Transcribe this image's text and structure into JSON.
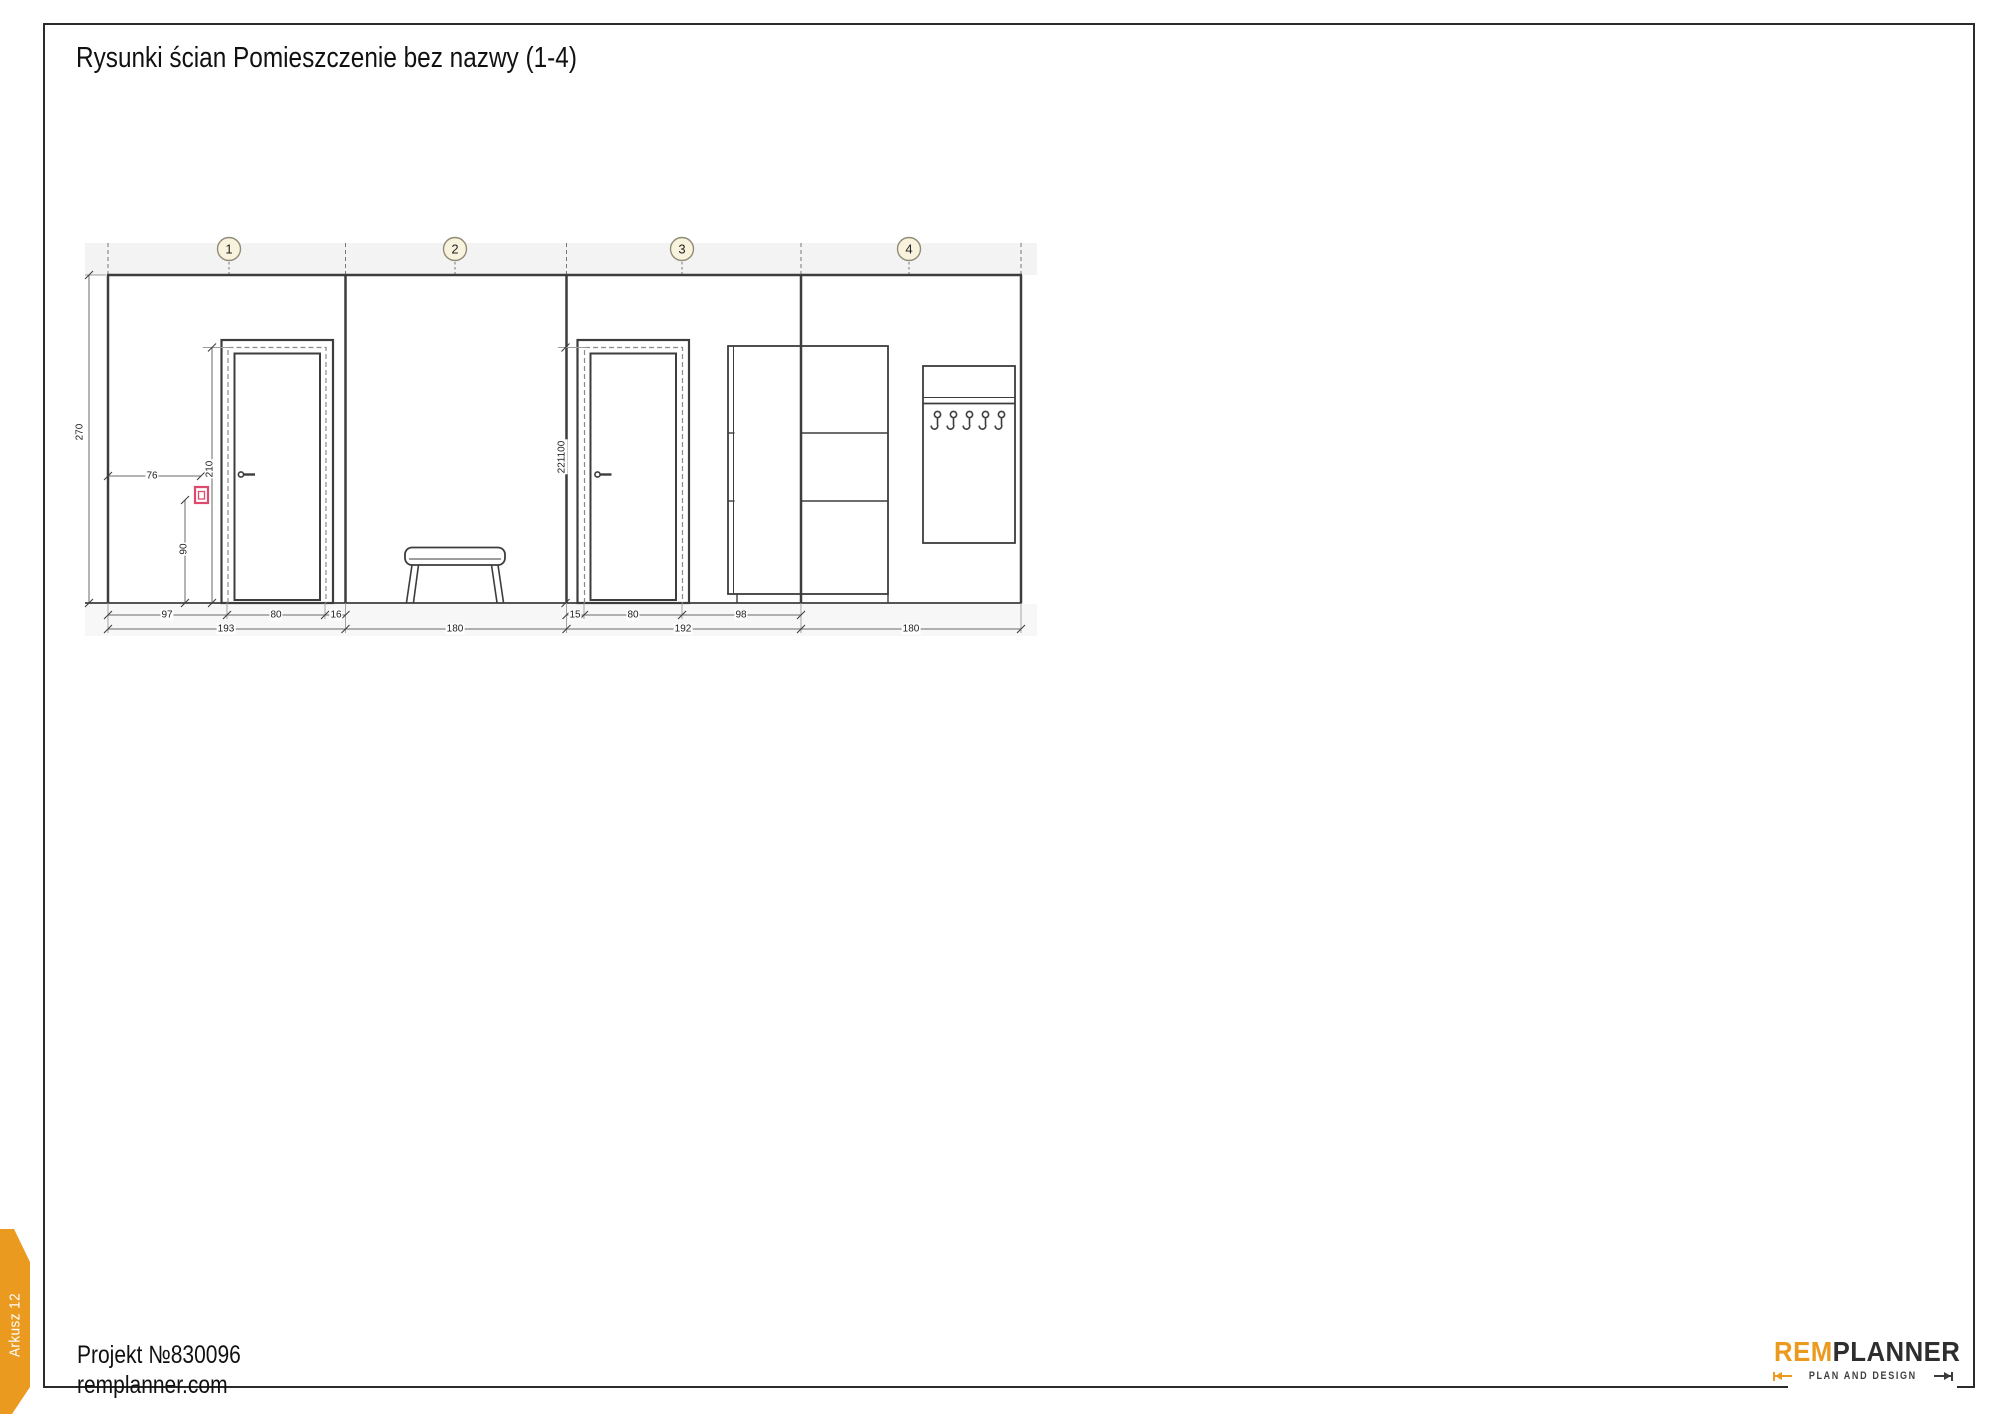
{
  "page": {
    "title": "Rysunki ścian Pomieszczenie bez nazwy (1-4)",
    "sheet_tab": "Arkusz 12"
  },
  "footer": {
    "project": "Projekt №830096",
    "website": "remplanner.com"
  },
  "logo": {
    "brand_left": "REM",
    "brand_right": "PLANNER",
    "tagline": "PLAN AND DESIGN"
  },
  "drawing": {
    "section_labels": [
      "1",
      "2",
      "3",
      "4"
    ],
    "dimensions": {
      "wall_height": "270",
      "socket_offset": "76",
      "door1_height": "210",
      "socket_height": "90",
      "wall1_segments": [
        "97",
        "80",
        "16"
      ],
      "wall1_total": "193",
      "wall2_total": "180",
      "door3_height": "221100",
      "wall3_segments": [
        "15",
        "80",
        "98"
      ],
      "wall3_total": "192",
      "wall4_total": "180"
    }
  },
  "colors": {
    "accent_orange": "#EB9A20",
    "socket_pink": "#DC4A6E",
    "line_dark": "#3D3D3D",
    "circle_fill": "#F9F2DC"
  }
}
